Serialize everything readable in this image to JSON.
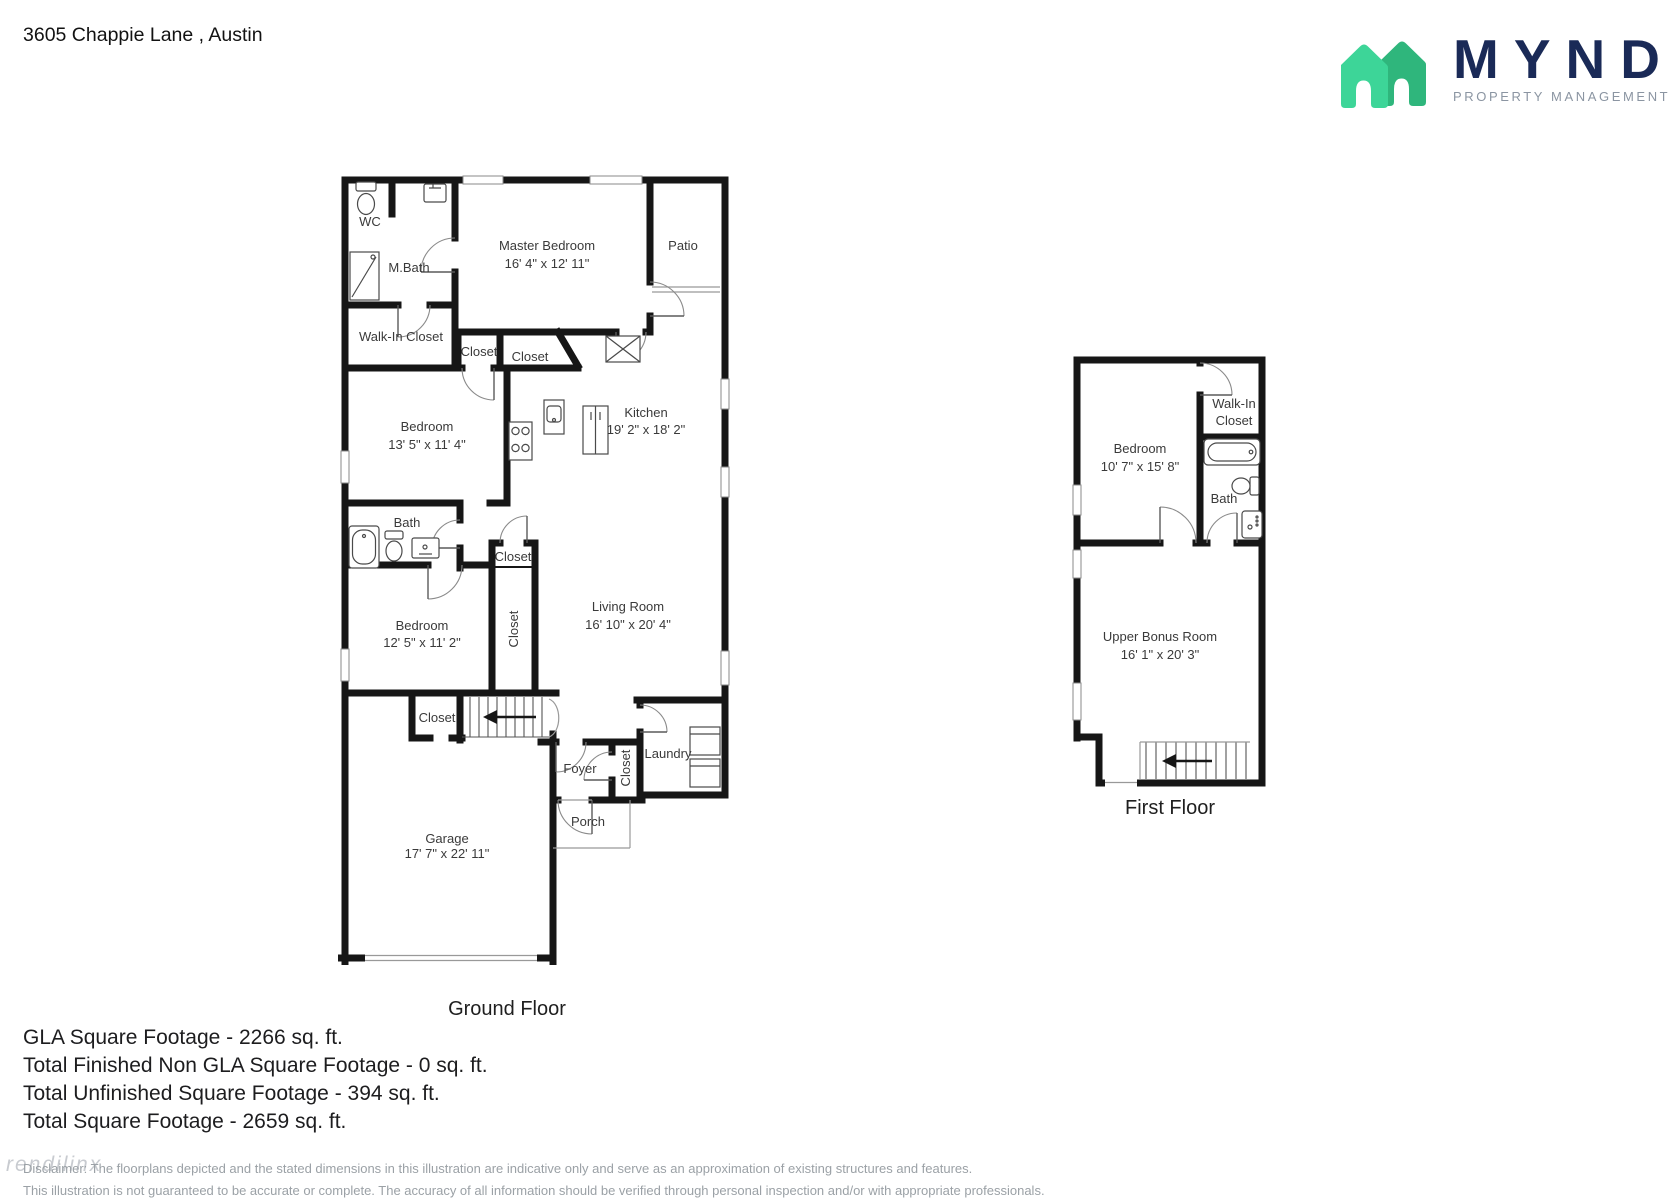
{
  "header": {
    "address": "3605 Chappie Lane , Austin",
    "brand": "MYND",
    "brand_tagline": "PROPERTY MANAGEMENT"
  },
  "colors": {
    "wall": "#161616",
    "brand_navy": "#1A2A57",
    "brand_green_light": "#3DD598",
    "brand_green_dark": "#2FB67C",
    "label": "#3A3A3A",
    "muted": "#9BA1A6"
  },
  "ground_floor": {
    "title": "Ground Floor",
    "wc": "WC",
    "mbath": "M.Bath",
    "walk_in_closet": "Walk-In Closet",
    "master_bedroom": {
      "name": "Master Bedroom",
      "dims": "16' 4\" x 12' 11\""
    },
    "patio": "Patio",
    "closet_a": "Closet",
    "closet_b": "Closet",
    "bedroom_1": {
      "name": "Bedroom",
      "dims": "13' 5\" x 11' 4\""
    },
    "kitchen": {
      "name": "Kitchen",
      "dims": "19' 2\" x 18' 2\""
    },
    "bath": "Bath",
    "closet_c": "Closet",
    "closet_d": "Closet",
    "bedroom_2": {
      "name": "Bedroom",
      "dims": "12' 5\" x 11' 2\""
    },
    "living_room": {
      "name": "Living Room",
      "dims": "16' 10\" x 20' 4\""
    },
    "closet_e": "Closet",
    "foyer": "Foyer",
    "closet_f": "Closet",
    "laundry": "Laundry",
    "porch": "Porch",
    "garage": {
      "name": "Garage",
      "dims": "17' 7\" x 22' 11\""
    }
  },
  "first_floor": {
    "title": "First Floor",
    "bedroom": {
      "name": "Bedroom",
      "dims": "10' 7\" x 15' 8\""
    },
    "walk_in_line1": "Walk-In",
    "walk_in_line2": "Closet",
    "bath": "Bath",
    "bonus": {
      "name": "Upper Bonus Room",
      "dims": "16' 1\" x 20' 3\""
    }
  },
  "summary": {
    "lines": [
      "GLA Square Footage - 2266 sq. ft.",
      "Total Finished Non GLA Square Footage - 0 sq. ft.",
      "Total Unfinished Square Footage - 394 sq. ft.",
      "Total Square Footage - 2659 sq. ft."
    ]
  },
  "footer": {
    "watermark": "rendilinx",
    "disclaimer_line1": "Disclaimer: The floorplans depicted and the stated dimensions in this illustration are indicative only and serve as an approximation of existing structures and features.",
    "disclaimer_line2": "This illustration is not guaranteed to be accurate or complete. The accuracy of all information should be verified through personal inspection and/or with appropriate professionals."
  }
}
